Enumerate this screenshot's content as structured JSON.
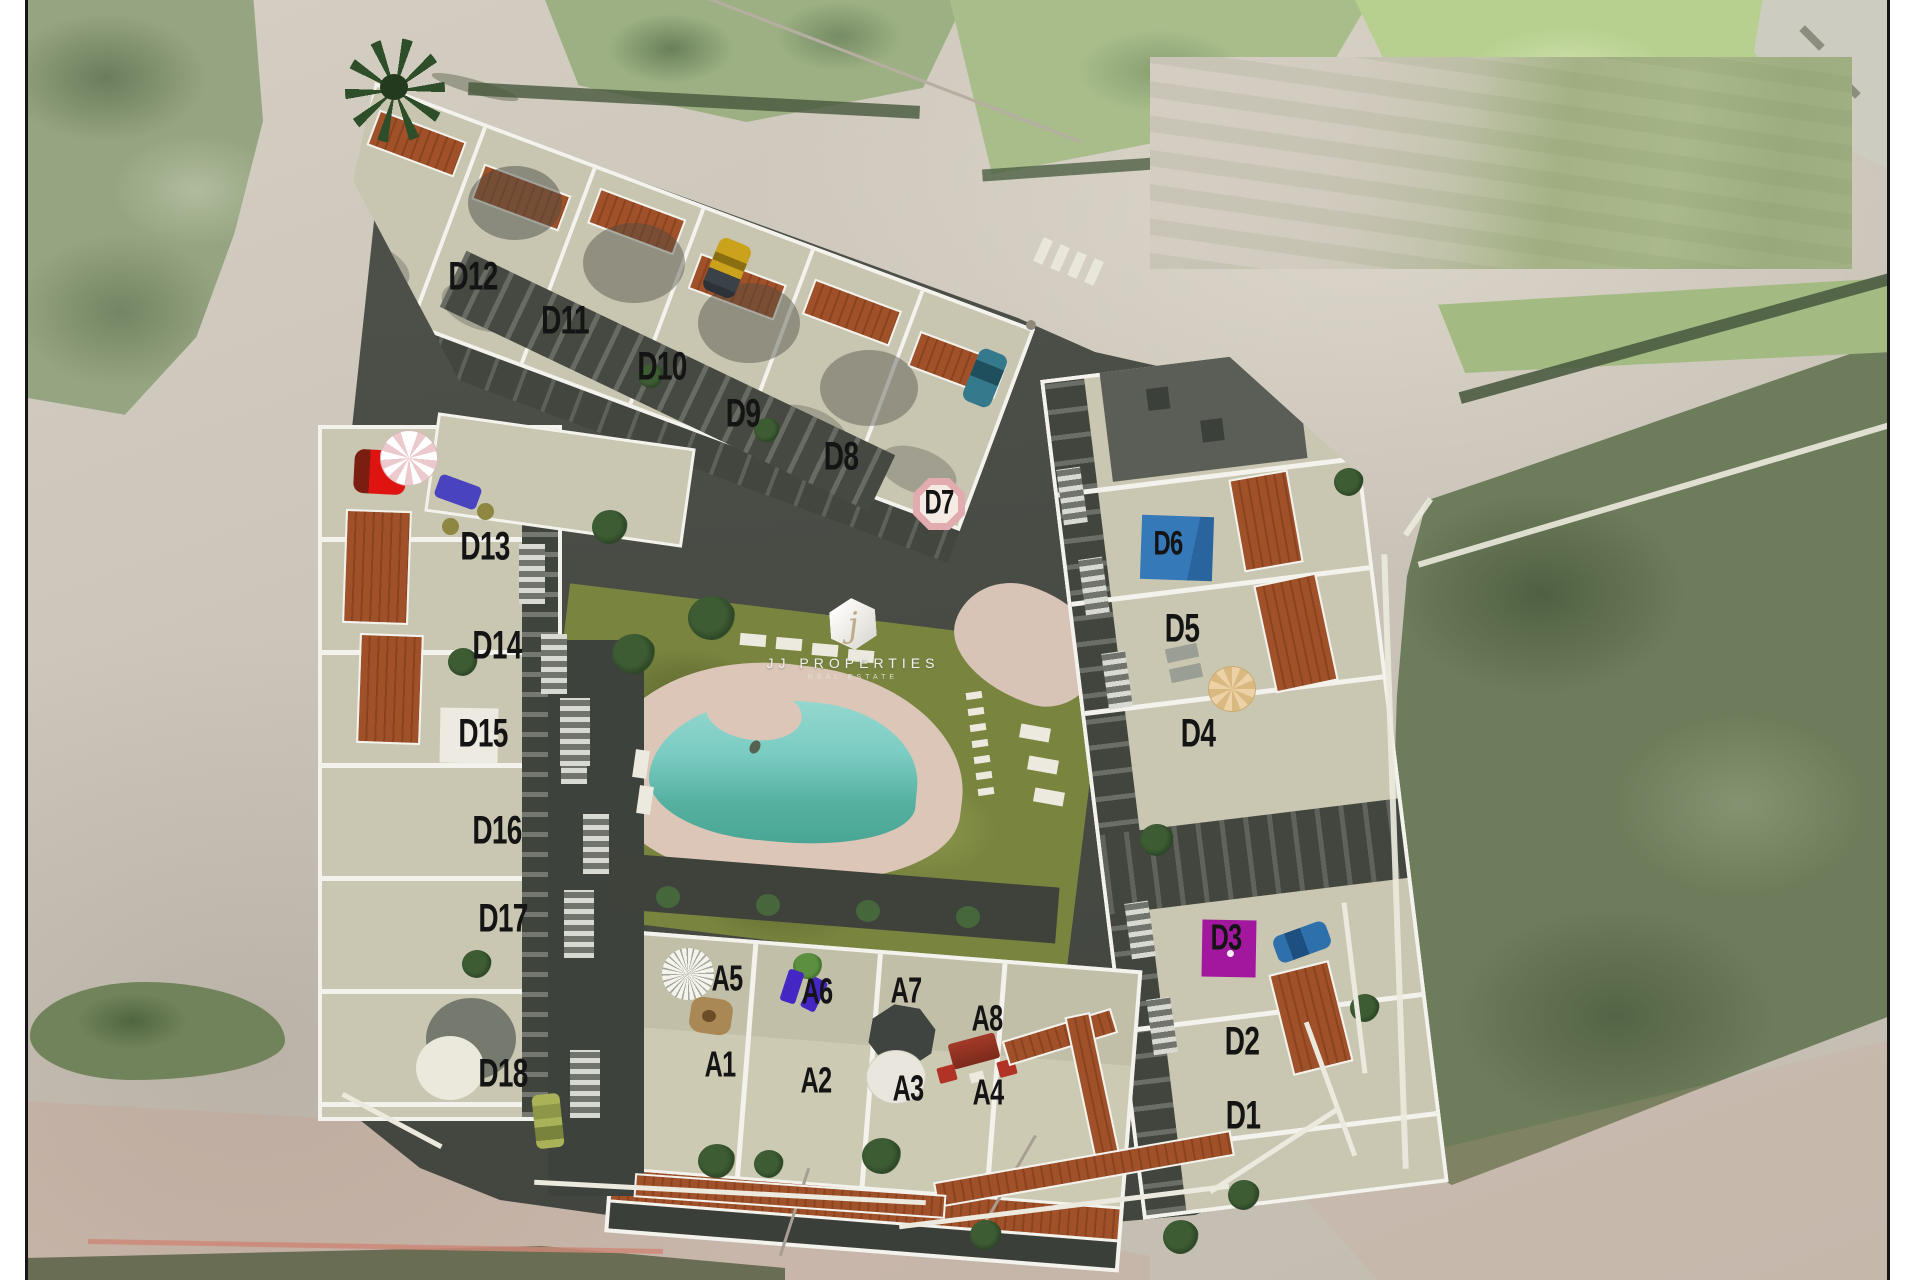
{
  "title": "Residential development aerial site plan",
  "watermark": {
    "symbol": "j",
    "name": "JJ PROPERTIES",
    "tagline": "REAL ESTATE"
  },
  "colors": {
    "unit_label": "#141414",
    "badge_blue": "#2f6fb0",
    "badge_magenta": "#a1179e",
    "badge_white": "#edebe1",
    "badge_pink_ring": "#e2abaf",
    "badge_pink_fill": "#f6eae5",
    "pool_water": "#6cc4b5",
    "lawn_green": "#79843f",
    "roof_terracotta": "#a0512a"
  },
  "site_plan": {
    "unit_groups": [
      {
        "prefix": "D",
        "count": 18
      },
      {
        "prefix": "A",
        "count": 8
      }
    ],
    "units": [
      {
        "id": "D12",
        "x": 473,
        "y": 278,
        "size": 40
      },
      {
        "id": "D11",
        "x": 565,
        "y": 322,
        "size": 40
      },
      {
        "id": "D10",
        "x": 662,
        "y": 368,
        "size": 40
      },
      {
        "id": "D9",
        "x": 743,
        "y": 415,
        "size": 40
      },
      {
        "id": "D8",
        "x": 841,
        "y": 458,
        "size": 40
      },
      {
        "id": "D7",
        "x": 939,
        "y": 504,
        "size": 34,
        "badge": {
          "type": "pink-octagon",
          "x": 913,
          "y": 478,
          "w": 52,
          "h": 52,
          "rot": 0
        }
      },
      {
        "id": "D13",
        "x": 485,
        "y": 548,
        "size": 40
      },
      {
        "id": "D14",
        "x": 497,
        "y": 647,
        "size": 40
      },
      {
        "id": "D15",
        "x": 483,
        "y": 735,
        "size": 40,
        "badge": {
          "type": "white-square",
          "x": 440,
          "y": 708,
          "w": 58,
          "h": 55,
          "rot": 1
        }
      },
      {
        "id": "D16",
        "x": 497,
        "y": 832,
        "size": 40
      },
      {
        "id": "D17",
        "x": 503,
        "y": 920,
        "size": 40
      },
      {
        "id": "D18",
        "x": 503,
        "y": 1075,
        "size": 40
      },
      {
        "id": "D6",
        "x": 1168,
        "y": 545,
        "size": 34,
        "badge": {
          "type": "blue-square",
          "x": 1141,
          "y": 516,
          "w": 72,
          "h": 64,
          "rot": 2
        }
      },
      {
        "id": "D5",
        "x": 1182,
        "y": 630,
        "size": 40
      },
      {
        "id": "D4",
        "x": 1198,
        "y": 735,
        "size": 40
      },
      {
        "id": "D3",
        "x": 1226,
        "y": 939,
        "size": 36,
        "badge": {
          "type": "magenta-square",
          "x": 1202,
          "y": 920,
          "w": 54,
          "h": 57,
          "rot": 1
        }
      },
      {
        "id": "D2",
        "x": 1242,
        "y": 1043,
        "size": 40
      },
      {
        "id": "D1",
        "x": 1243,
        "y": 1117,
        "size": 40
      },
      {
        "id": "A5",
        "x": 727,
        "y": 980,
        "size": 36
      },
      {
        "id": "A6",
        "x": 817,
        "y": 993,
        "size": 36
      },
      {
        "id": "A7",
        "x": 906,
        "y": 992,
        "size": 36
      },
      {
        "id": "A8",
        "x": 987,
        "y": 1020,
        "size": 36
      },
      {
        "id": "A1",
        "x": 720,
        "y": 1066,
        "size": 36
      },
      {
        "id": "A2",
        "x": 816,
        "y": 1082,
        "size": 36
      },
      {
        "id": "A3",
        "x": 908,
        "y": 1090,
        "size": 36
      },
      {
        "id": "A4",
        "x": 988,
        "y": 1094,
        "size": 36
      }
    ]
  }
}
